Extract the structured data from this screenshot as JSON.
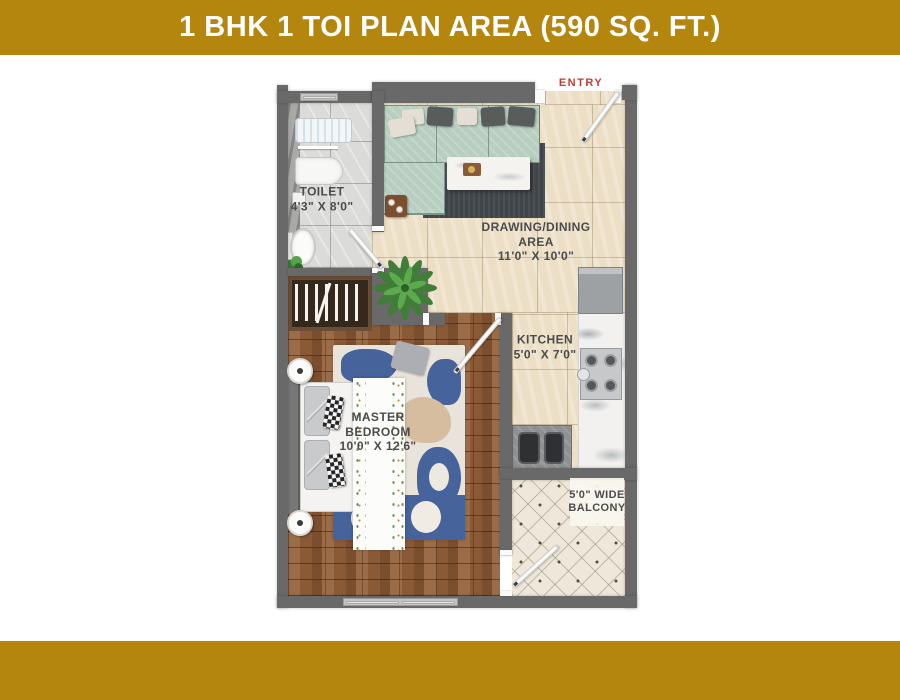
{
  "header": {
    "title": "1 BHK 1 TOI PLAN AREA (590 SQ. FT.)"
  },
  "plan": {
    "entry_label": "ENTRY",
    "rooms": {
      "toilet": {
        "name": "TOILET",
        "dims": "4'3\" X 8'0\""
      },
      "drawing_dining": {
        "name": "DRAWING/DINING AREA",
        "dims": "11'0\" X 10'0\""
      },
      "kitchen": {
        "name": "KITCHEN",
        "dims": "5'0\" X 7'0\""
      },
      "master_bedroom": {
        "name": "MASTER BEDROOM",
        "dims": "10'0\" X 12'6\""
      },
      "balcony": {
        "name": "5'0\" WIDE BALCONY"
      }
    }
  },
  "colors": {
    "band_gold": "#B5860D",
    "title_text": "#FFFFFF",
    "entry_red": "#C03C32",
    "label_gray": "#4B4B4B",
    "wall_gray": "#696969",
    "wood_floor": "#8A5A36",
    "tile_beige": "#ECDFC6",
    "tile_gray": "#DBDBD9",
    "balcony_cream": "#EFE7D9",
    "sofa_green": "#B8CEC0",
    "rug_charcoal": "#3F4548",
    "bedroom_rug_blue": "#46639B"
  }
}
